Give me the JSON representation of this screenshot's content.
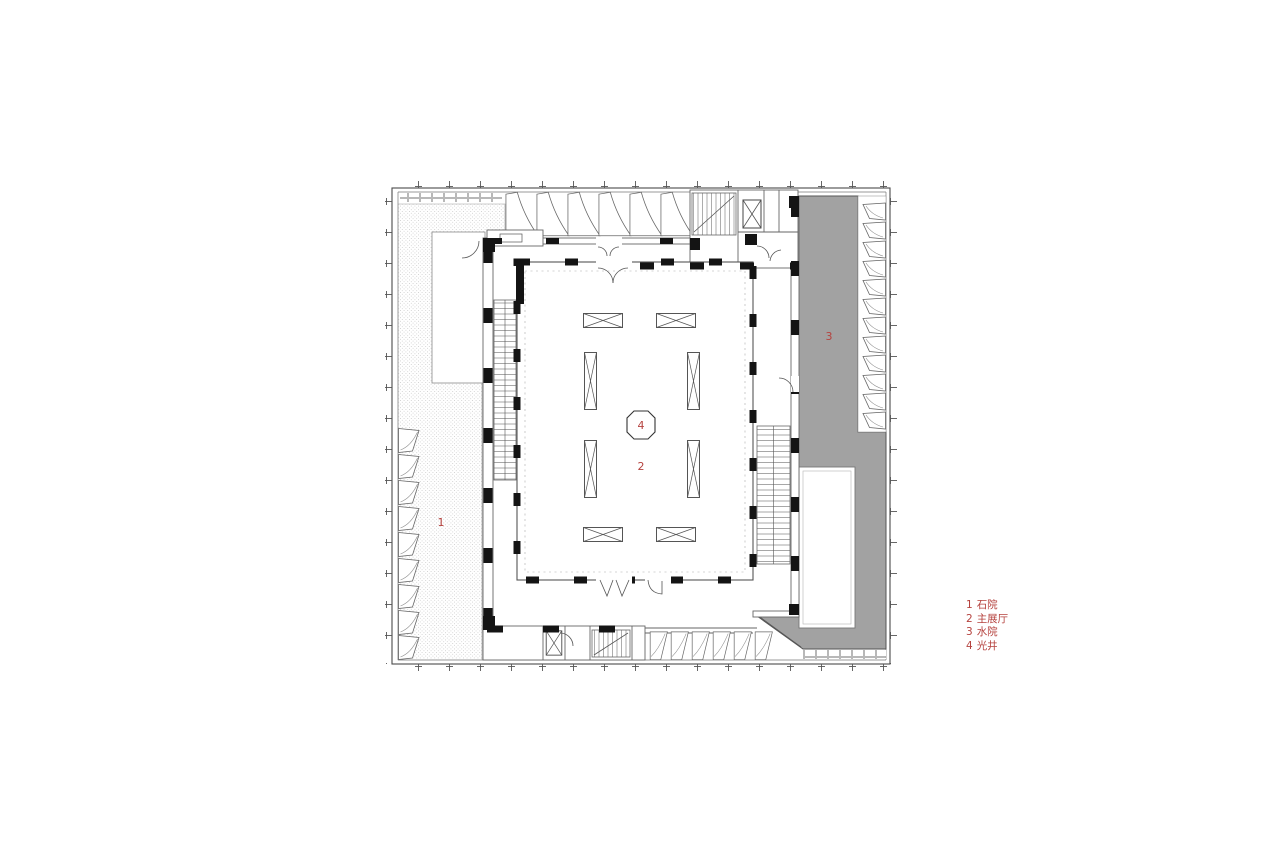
{
  "colors": {
    "label-red": "#b5423e",
    "water-gray": "#a2a2a2",
    "line-dark": "#3f3f3f"
  },
  "plan_labels": {
    "stone_courtyard": "1",
    "main_hall": "2",
    "water_courtyard": "3",
    "light_well": "4"
  },
  "legend": {
    "items": [
      {
        "num": "1",
        "name": "石院"
      },
      {
        "num": "2",
        "name": "主展厅"
      },
      {
        "num": "3",
        "name": "水院"
      },
      {
        "num": "4",
        "name": "光井"
      }
    ]
  }
}
